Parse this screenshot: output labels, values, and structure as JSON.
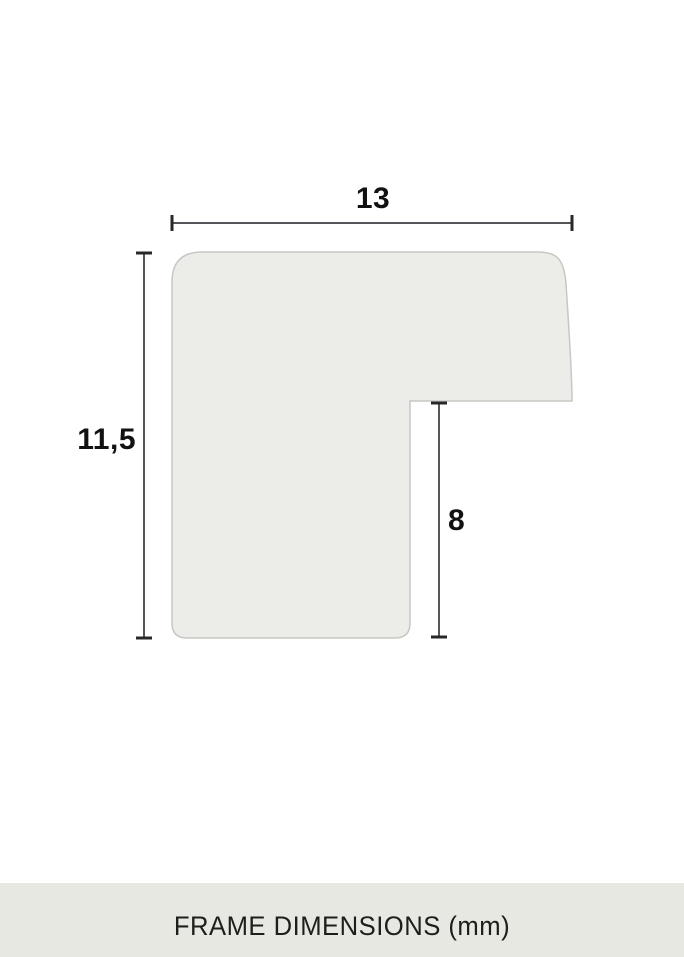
{
  "diagram": {
    "dimensions": {
      "width": {
        "label": "13"
      },
      "height": {
        "label": "11,5"
      },
      "rabbet": {
        "label": "8"
      }
    },
    "colors": {
      "shape_fill": "#ECECE8",
      "shape_stroke": "#C7C7C3",
      "dimension_line": "#55555A",
      "dimension_tick": "#28282B",
      "label_text": "#121212"
    }
  },
  "footer": {
    "caption": "FRAME DIMENSIONS (mm)",
    "colors": {
      "background": "#E8E8E3",
      "text": "#1E1E1C"
    }
  }
}
